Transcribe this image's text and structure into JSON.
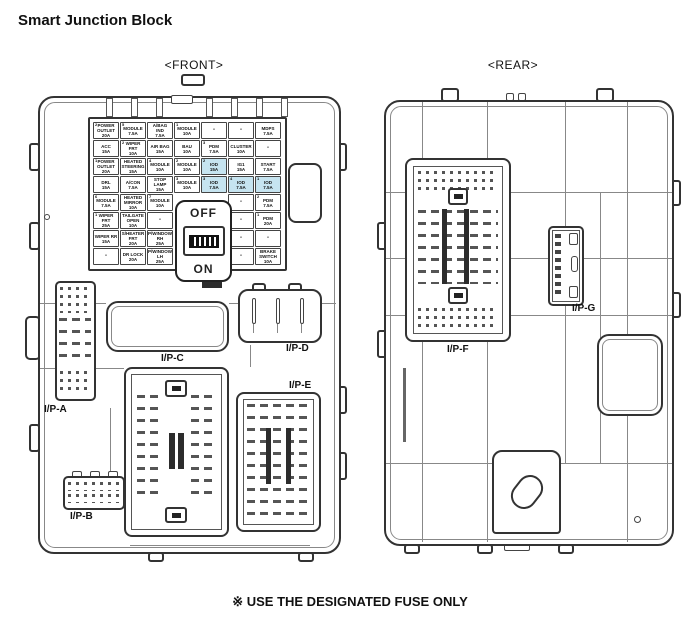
{
  "page": {
    "title": "Smart Junction Block",
    "front_caption": "<FRONT>",
    "rear_caption": "<REAR>",
    "footer_note": "※ USE THE DESIGNATED FUSE ONLY"
  },
  "colors": {
    "fuse_highlight": "#c6e4f0"
  },
  "switch": {
    "off_label": "OFF",
    "on_label": "ON"
  },
  "connector_labels": {
    "ip_a": "I/P-A",
    "ip_b": "I/P-B",
    "ip_c": "I/P-C",
    "ip_d": "I/P-D",
    "ip_e": "I/P-E",
    "ip_f": "I/P-F",
    "ip_g": "I/P-G"
  },
  "fuse_grid": {
    "cell_w": 27,
    "cell_h": 18,
    "rows": [
      [
        {
          "s": "2",
          "n": "POWER OUTLET",
          "a": "20A"
        },
        {
          "s": "5",
          "n": "MODULE",
          "a": "7.5A"
        },
        {
          "n": "A/BAG IND",
          "a": "7.5A"
        },
        {
          "s": "1",
          "n": "MODULE",
          "a": "10A"
        },
        {
          "n": "-"
        },
        {
          "n": "-"
        },
        {
          "n": "MDPS",
          "a": "7.5A"
        }
      ],
      [
        {
          "n": "ACC",
          "a": "15A"
        },
        {
          "s": "2",
          "n": "WIPER FRT",
          "a": "10A"
        },
        {
          "n": "AIR BAG",
          "a": "15A"
        },
        {
          "n": "BAU",
          "a": "10A"
        },
        {
          "s": "3",
          "n": "PDM",
          "a": "7.5A"
        },
        {
          "n": "CLUSTER",
          "a": "10A"
        },
        {
          "n": "-"
        }
      ],
      [
        {
          "s": "1",
          "n": "POWER OUTLET",
          "a": "20A"
        },
        {
          "n": "HEATED STEERING",
          "a": "15A"
        },
        {
          "s": "4",
          "n": "MODULE",
          "a": "10A"
        },
        {
          "s": "2",
          "n": "MODULE",
          "a": "10A"
        },
        {
          "s": "2",
          "n": "IOD",
          "a": "15A",
          "hl": true
        },
        {
          "n": "IG1",
          "a": "15A"
        },
        {
          "n": "START",
          "a": "7.5A"
        }
      ],
      [
        {
          "n": "DRL",
          "a": "15A"
        },
        {
          "n": "A/CON",
          "a": "7.5A"
        },
        {
          "n": "STOP LAMP",
          "a": "15A"
        },
        {
          "s": "3",
          "n": "MODULE",
          "a": "10A"
        },
        {
          "s": "3",
          "n": "IOD",
          "a": "7.5A",
          "hl": true
        },
        {
          "s": "4",
          "n": "IOD",
          "a": "7.5A",
          "hl": true
        },
        {
          "s": "1",
          "n": "IOD",
          "a": "7.5A",
          "hl": true
        }
      ],
      [
        {
          "s": "6",
          "n": "MODULE",
          "a": "7.5A"
        },
        {
          "n": "HEATED MIRROR",
          "a": "10A"
        },
        {
          "s": "7",
          "n": "MODULE",
          "a": "10A"
        },
        null,
        null,
        {
          "n": "-"
        },
        {
          "s": "2",
          "n": "PDM",
          "a": "7.5A"
        }
      ],
      [
        {
          "s": "1",
          "n": "WIPER FRT",
          "a": "25A"
        },
        {
          "n": "TAILGATE OPEN",
          "a": "10A"
        },
        {
          "n": "-"
        },
        null,
        null,
        {
          "n": "-"
        },
        {
          "s": "1",
          "n": "PDM",
          "a": "20A"
        }
      ],
      [
        {
          "n": "WIPER RR",
          "a": "15A"
        },
        {
          "n": "S/HEATER FRT",
          "a": "20A"
        },
        {
          "n": "P/WINDOW RH",
          "a": "25A"
        },
        null,
        null,
        {
          "n": "-"
        },
        {
          "n": "-"
        }
      ],
      [
        {
          "n": "-"
        },
        {
          "n": "DR LOCK",
          "a": "20A"
        },
        {
          "n": "P/WINDOW LH",
          "a": "25A"
        },
        null,
        null,
        {
          "n": "-"
        },
        {
          "n": "BRAKE SWITCH",
          "a": "10A"
        }
      ]
    ]
  }
}
